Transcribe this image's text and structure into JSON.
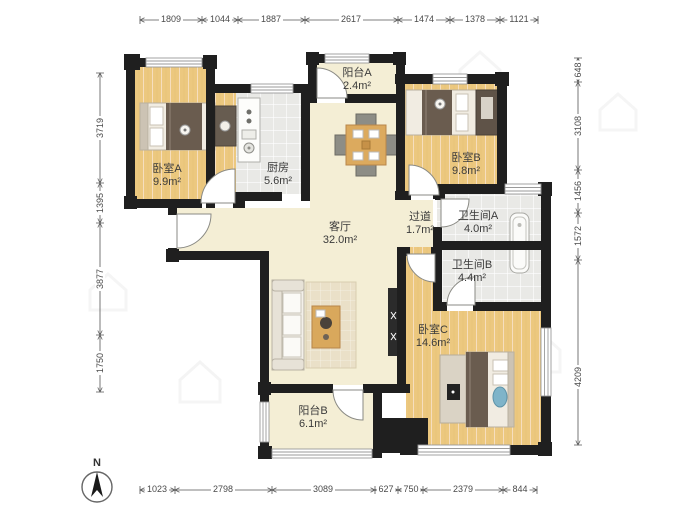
{
  "plan": {
    "type": "residential-floor-plan",
    "compass_label": "N"
  },
  "rooms": [
    {
      "id": "bedroom-a",
      "name": "卧室A",
      "area": "9.9m²"
    },
    {
      "id": "kitchen",
      "name": "厨房",
      "area": "5.6m²"
    },
    {
      "id": "balcony-a",
      "name": "阳台A",
      "area": "2.4m²"
    },
    {
      "id": "bedroom-b",
      "name": "卧室B",
      "area": "9.8m²"
    },
    {
      "id": "living-room",
      "name": "客厅",
      "area": "32.0m²"
    },
    {
      "id": "hallway",
      "name": "过道",
      "area": "1.7m²"
    },
    {
      "id": "bathroom-a",
      "name": "卫生间A",
      "area": "4.0m²"
    },
    {
      "id": "bathroom-b",
      "name": "卫生间B",
      "area": "4.4m²"
    },
    {
      "id": "bedroom-c",
      "name": "卧室C",
      "area": "14.6m²"
    },
    {
      "id": "balcony-b",
      "name": "阳台B",
      "area": "6.1m²"
    }
  ],
  "dimensions": {
    "top": [
      "1809",
      "1044",
      "1887",
      "2617",
      "1474",
      "1378",
      "1121"
    ],
    "bottom": [
      "1023",
      "2798",
      "3089",
      "627",
      "750",
      "2379",
      "844"
    ],
    "left": [
      "3719",
      "1395",
      "3877",
      "1750"
    ],
    "right": [
      "648",
      "3108",
      "1456",
      "1572",
      "4209"
    ]
  },
  "colors": {
    "wall": "#1f1f1f",
    "wood_floor": "#ecc87f",
    "cream_floor": "#f4eed5",
    "tile_floor": "#e9e9e6",
    "blanket": "#6a5c4f",
    "accent_blue": "#7fb4c9"
  }
}
